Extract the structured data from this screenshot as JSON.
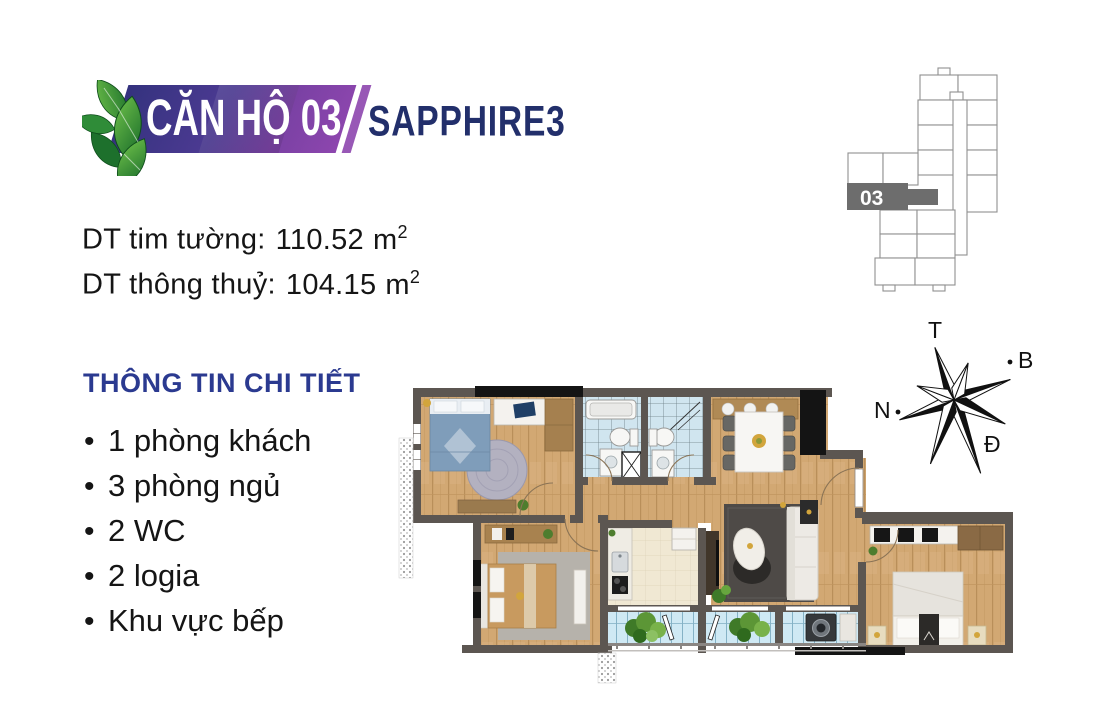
{
  "logo": {
    "badge": "CĂN HỘ 03",
    "brand": "SAPPHIRE3"
  },
  "areas": {
    "lines": [
      {
        "label": "DT tim tường:",
        "value": "110.52",
        "unit": "m",
        "exp": "2"
      },
      {
        "label": "DT thông thuỷ:",
        "value": "104.15",
        "unit": "m",
        "exp": "2"
      }
    ]
  },
  "details": {
    "heading": "THÔNG TIN CHI TIẾT",
    "bullet": "•",
    "items": [
      "1 phòng khách",
      "3 phòng ngủ",
      "2 WC",
      "2 logia",
      "Khu vực bếp"
    ]
  },
  "keyplan": {
    "unit_label": "03"
  },
  "compass": {
    "top": "T",
    "right": "B",
    "left": "N",
    "bottom": "Đ"
  },
  "palette": {
    "wall": "#5c5651",
    "blackw": "#141414",
    "wood": "#d2a873",
    "tile": "#d0e5ef",
    "balcony": "#cfe9f4",
    "cream": "#f0e8d3",
    "rugdark": "#4e4a47",
    "ruglight": "#b6b2ab",
    "roundrug": "#b3b1c0",
    "navy": "#222f6b",
    "indigo": "#34327e",
    "purple": "#8d46ae",
    "headblue": "#2b3a90",
    "gold": "#d2a53c",
    "leafdark": "#1d702c",
    "leaflight": "#6dbf49",
    "bedblue": "#7f9dba",
    "bedtan": "#c89a5f",
    "keygrey": "#8f8f8f",
    "keydark": "#6d6d6d"
  }
}
